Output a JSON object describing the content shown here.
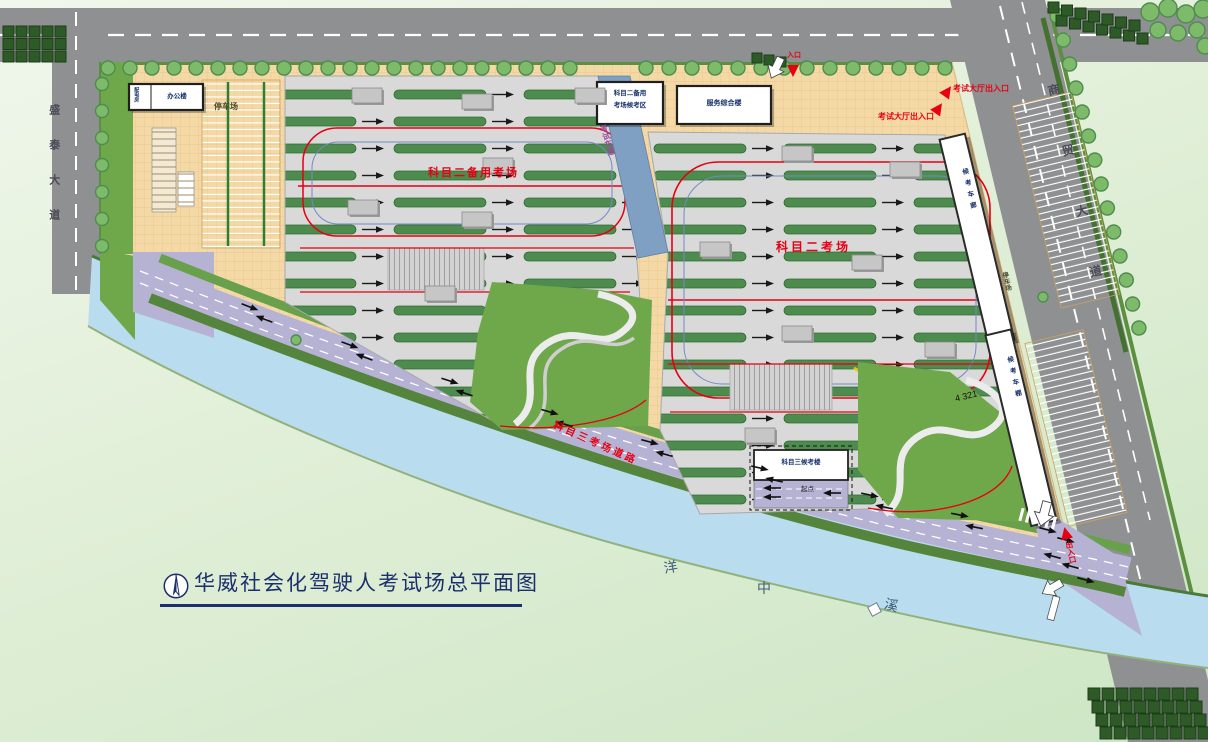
{
  "title": {
    "text": "华威社会化驾驶人考试场总平面图"
  },
  "streets": {
    "left_avenue": "盛泰大道",
    "right_avenue": "商贸大道"
  },
  "river": {
    "name": "洋中溪",
    "char_1": "洋",
    "char_2": "中",
    "char_3": "溪"
  },
  "fields": {
    "subject2_backup_label": "科目二备用考场",
    "subject2_label": "科目二考场",
    "subject3_road_label": "科目三考场道路",
    "test_lane_label": "考试车道",
    "lane_numbers": "4 321",
    "start_point": "起点"
  },
  "gates": {
    "exam_hall_gate_upper": "考试大厅出入口",
    "exam_hall_gate_lower": "考试大厅出入口",
    "north_gate": "入口",
    "south_gate": "出入口"
  },
  "buildings": {
    "waiting_area_line1": "科目二备用",
    "waiting_area_line2": "考场候考区",
    "service_center": "服务综合楼",
    "subject3_waiting": "科目三候考楼",
    "office": "办公楼",
    "utility": "配电房",
    "carport_upper": "候考车廊",
    "carport_lower": "候考车棚"
  },
  "parking": {
    "west_lot": "停车场",
    "east_lot": "停车场"
  },
  "colors": {
    "site_tan": "#f4d9a6",
    "field_gray": "#d9d9d9",
    "lane_green": "#4e8b4e",
    "lawn_green": "#6fa74b",
    "river_blue": "#b9dcee",
    "pond_blue": "#7fa0c2",
    "road_gray": "#8f9092",
    "purple_road": "#b5b2d4",
    "tree_green": "#7dba6a",
    "hedge_green": "#2d5a27",
    "accent_red": "#e60012",
    "title_navy": "#1b2f6e"
  }
}
